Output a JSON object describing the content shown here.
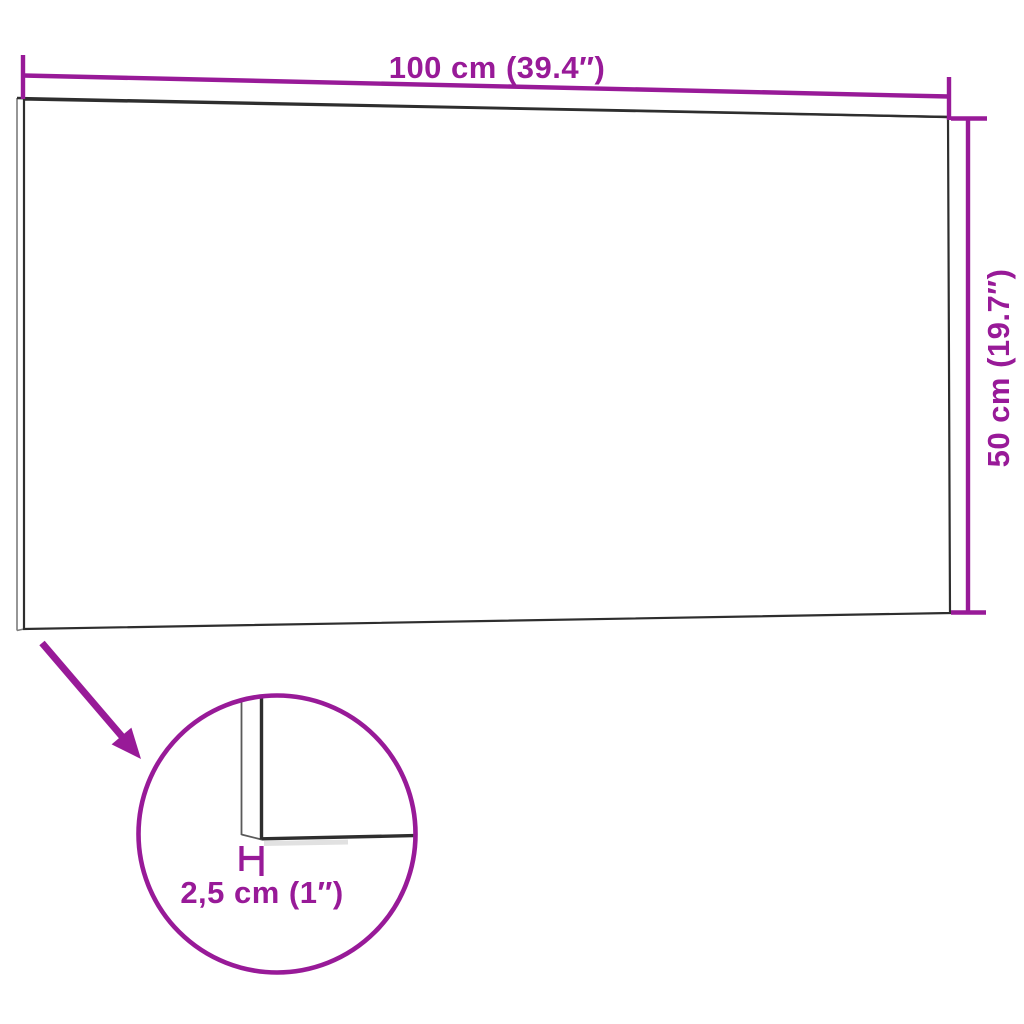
{
  "image": {
    "title": "Wall panel dimension diagram",
    "background": "#ffffff"
  },
  "colors": {
    "dimension": "#981A98",
    "outline": "#2e2e2e",
    "outline_thin": "#7c7c7c",
    "detail_line_thin": "#5a5a5a",
    "detail_shadow": "#c9c9c9"
  },
  "dimensions": {
    "width": {
      "label": "100 cm (39.4″)",
      "value_cm": 100,
      "value_in": 39.4
    },
    "height": {
      "label": "50 cm (19.7″)",
      "value_cm": 50,
      "value_in": 19.7
    },
    "thickness": {
      "label": "2,5 cm (1″)",
      "value_cm": 2.5,
      "value_in": 1
    }
  }
}
